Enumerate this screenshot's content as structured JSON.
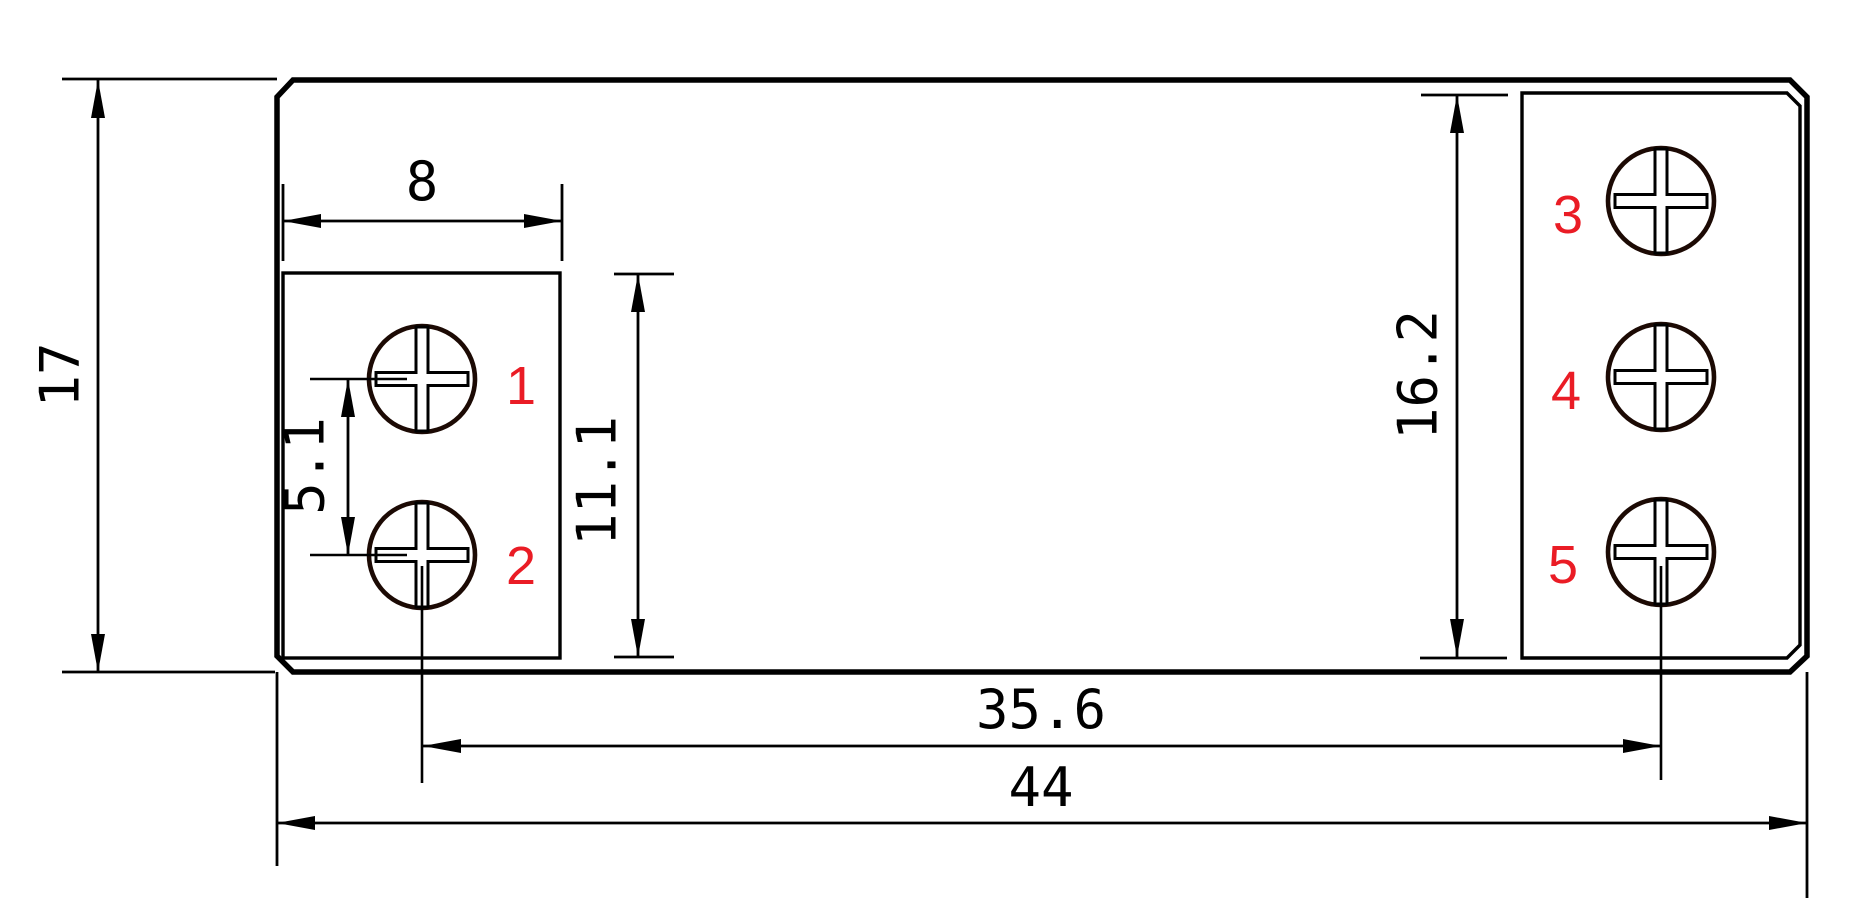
{
  "colors": {
    "line": "#000000",
    "screw_outline": "#1c0a04",
    "terminal_label": "#ea1c25",
    "background": "#ffffff"
  },
  "dimensions": {
    "overall_width": "44",
    "overall_height": "17",
    "terminal_block_width": "8",
    "screw_pitch": "5.1",
    "left_block_height": "11.1",
    "right_block_height": "16.2",
    "screw_centers_span": "35.6"
  },
  "terminal_labels": [
    "1",
    "2",
    "3",
    "4",
    "5"
  ]
}
